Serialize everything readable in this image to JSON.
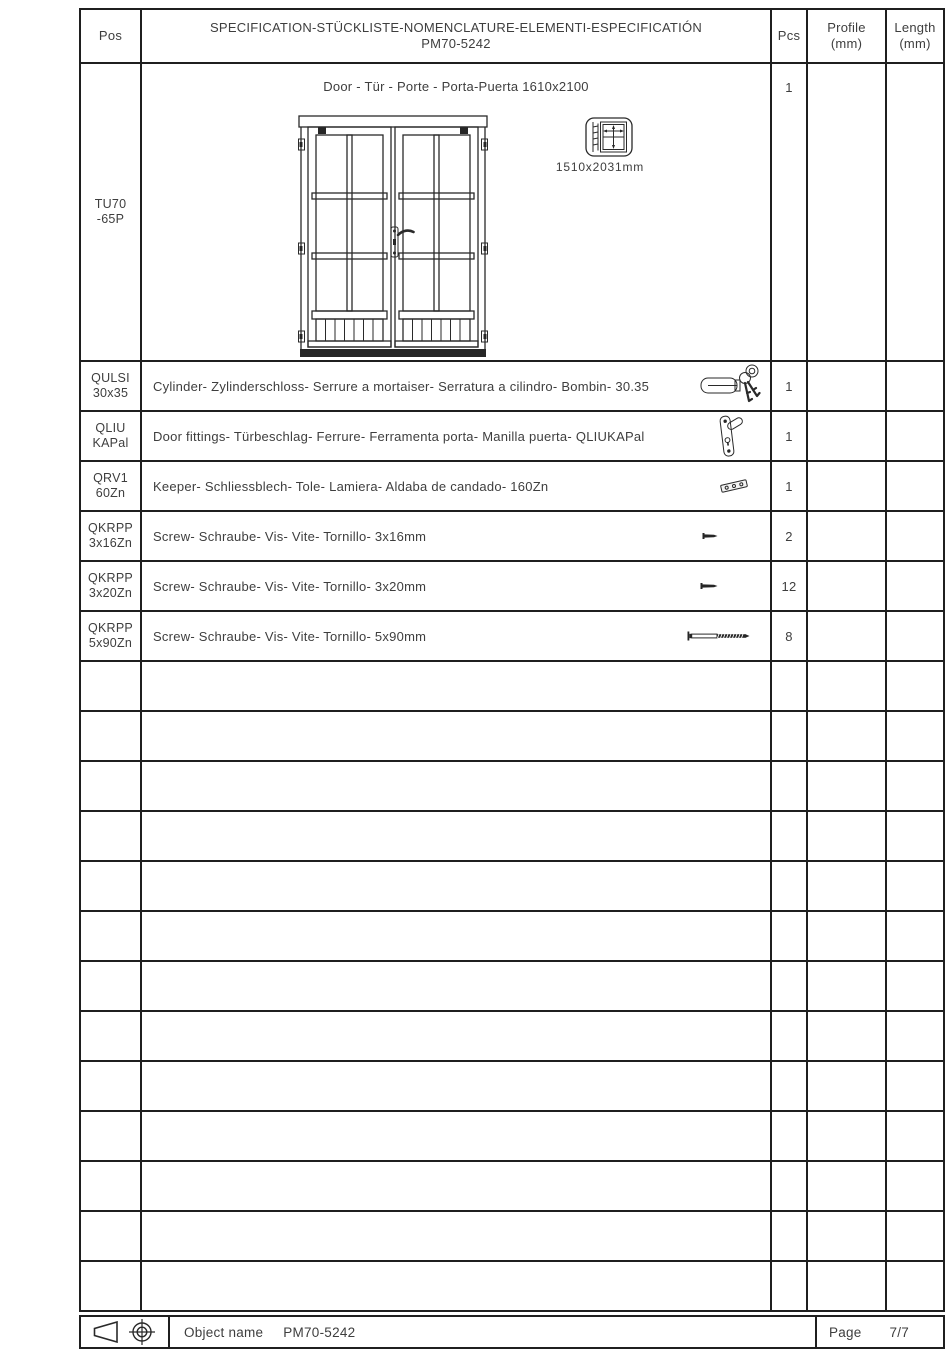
{
  "header": {
    "pos": "Pos",
    "title_line1": "SPECIFICATION-STÜCKLISTE-NOMENCLATURE-ELEMENTI-ESPECIFICATIÓN",
    "title_line2": "PM70-5242",
    "pcs": "Pcs",
    "profile_line1": "Profile",
    "profile_line2": "(mm)",
    "length_line1": "Length",
    "length_line2": "(mm)"
  },
  "door_row": {
    "pos_line1": "TU70",
    "pos_line2": "-65P",
    "title": "Door - Tür - Porte - Porta-Puerta 1610x2100",
    "size_label": "1510x2031mm",
    "pcs": "1",
    "drawing": "double-glazed-door-front-view",
    "dimension_icon": "door-frame-dimension-icon"
  },
  "items": [
    {
      "pos_line1": "QULSI",
      "pos_line2": "30x35",
      "description": "Cylinder- Zylinderschloss- Serrure a mortaiser- Serratura a cilindro- Bombin- 30.35",
      "icon": "cylinder-lock-keys-icon",
      "pcs": "1"
    },
    {
      "pos_line1": "QLIU",
      "pos_line2": "KAPal",
      "description": "Door fittings- Türbeschlag- Ferrure- Ferramenta porta- Manilla puerta- QLIUKAPal",
      "icon": "door-handle-icon",
      "pcs": "1"
    },
    {
      "pos_line1": "QRV1",
      "pos_line2": "60Zn",
      "description": "Keeper- Schliessblech- Tole- Lamiera- Aldaba de candado- 160Zn",
      "icon": "strike-plate-icon",
      "pcs": "1"
    },
    {
      "pos_line1": "QKRPP",
      "pos_line2": "3x16Zn",
      "description": "Screw- Schraube- Vis- Vite- Tornillo- 3x16mm",
      "icon": "screw-small-icon",
      "pcs": "2"
    },
    {
      "pos_line1": "QKRPP",
      "pos_line2": "3x20Zn",
      "description": "Screw- Schraube- Vis- Vite- Tornillo- 3x20mm",
      "icon": "screw-small-icon",
      "pcs": "12"
    },
    {
      "pos_line1": "QKRPP",
      "pos_line2": "5x90Zn",
      "description": "Screw- Schraube- Vis- Vite- Tornillo- 5x90mm",
      "icon": "screw-long-icon",
      "pcs": "8"
    }
  ],
  "empty_row_count": 13,
  "footer": {
    "symbols": [
      "first-angle-projection-cone-icon",
      "datum-crosshair-icon"
    ],
    "object_name_label": "Object name",
    "object_name_value": "PM70-5242",
    "page_label": "Page",
    "page_value": "7/7"
  },
  "colors": {
    "line": "#1f1f1f",
    "text": "#3e3e3e",
    "background": "#ffffff"
  }
}
